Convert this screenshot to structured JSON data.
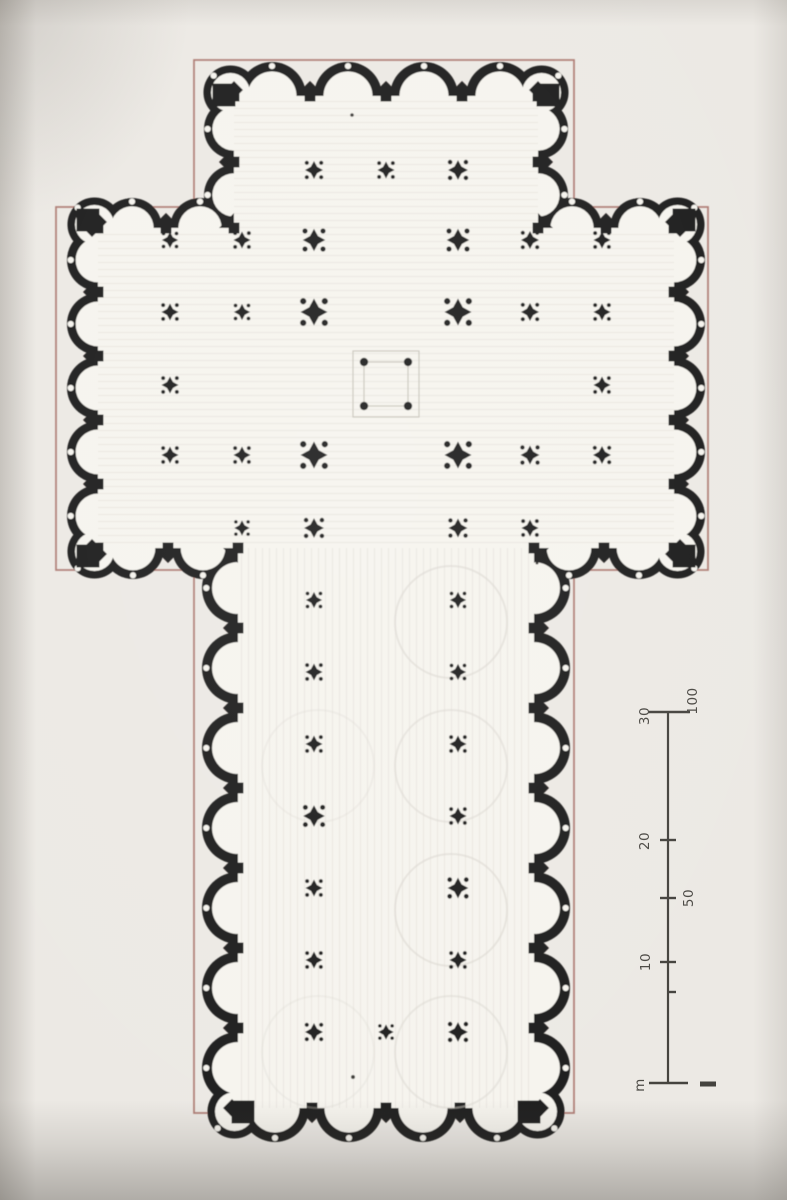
{
  "meta": {
    "description": "Scanned book photograph of a Latin-cross cathedral floor plan, rotated 90 degrees, with semicircular chapel niches scalloping the whole perimeter, an interior grid of cross-shaped piers, a square crossing marked by four dots, thin red construction rectangles around nave and transept, and a double scale bar in metres",
    "plan_type": "cruciform-cathedral-floor-plan"
  },
  "palette": {
    "paper": "#ECE9E4",
    "floor": "#F6F4EE",
    "ink": "#1E1D1B",
    "red_outline": "#AD7A72",
    "faint_line": "#D9D6CF",
    "crossing_line": "#C9C5BC",
    "scale_ink": "#44423D",
    "scale_label_ink": "#4A4843",
    "shade": "#5C564E"
  },
  "plan": {
    "red_frames": [
      {
        "x": 194,
        "y": 60,
        "w": 380,
        "h": 1053
      },
      {
        "x": 56,
        "y": 207,
        "w": 652,
        "h": 363
      }
    ],
    "floors": [
      {
        "x": 234,
        "y": 96,
        "w": 304,
        "h": 132,
        "tex": "h"
      },
      {
        "x": 98,
        "y": 228,
        "w": 576,
        "h": 320,
        "tex": "h"
      },
      {
        "x": 238,
        "y": 548,
        "w": 296,
        "h": 560,
        "tex": "v"
      }
    ],
    "edges": [
      {
        "x1": 234,
        "y1": 96,
        "x2": 538,
        "y2": 96,
        "out": "up",
        "bays": 4,
        "r": 34
      },
      {
        "x1": 234,
        "y1": 96,
        "x2": 234,
        "y2": 228,
        "out": "left",
        "bays": 2,
        "r": 30
      },
      {
        "x1": 538,
        "y1": 96,
        "x2": 538,
        "y2": 228,
        "out": "right",
        "bays": 2,
        "r": 30
      },
      {
        "x1": 98,
        "y1": 228,
        "x2": 234,
        "y2": 228,
        "out": "up",
        "bays": 2,
        "r": 30
      },
      {
        "x1": 538,
        "y1": 228,
        "x2": 674,
        "y2": 228,
        "out": "up",
        "bays": 2,
        "r": 30
      },
      {
        "x1": 98,
        "y1": 228,
        "x2": 98,
        "y2": 548,
        "out": "left",
        "bays": 5,
        "r": 31
      },
      {
        "x1": 674,
        "y1": 228,
        "x2": 674,
        "y2": 548,
        "out": "right",
        "bays": 5,
        "r": 31
      },
      {
        "x1": 98,
        "y1": 548,
        "x2": 238,
        "y2": 548,
        "out": "down",
        "bays": 2,
        "r": 31
      },
      {
        "x1": 534,
        "y1": 548,
        "x2": 674,
        "y2": 548,
        "out": "down",
        "bays": 2,
        "r": 31
      },
      {
        "x1": 238,
        "y1": 548,
        "x2": 238,
        "y2": 1108,
        "out": "left",
        "bays": 7,
        "r": 36
      },
      {
        "x1": 534,
        "y1": 548,
        "x2": 534,
        "y2": 1108,
        "out": "right",
        "bays": 7,
        "r": 36
      },
      {
        "x1": 238,
        "y1": 1108,
        "x2": 534,
        "y2": 1108,
        "out": "down",
        "bays": 4,
        "r": 34
      }
    ],
    "corner_lobes": [
      {
        "x": 234,
        "y": 96,
        "a": -135,
        "r": 27
      },
      {
        "x": 538,
        "y": 96,
        "a": -45,
        "r": 27
      },
      {
        "x": 98,
        "y": 228,
        "a": -135,
        "r": 27
      },
      {
        "x": 674,
        "y": 228,
        "a": -45,
        "r": 27
      },
      {
        "x": 98,
        "y": 548,
        "a": 135,
        "r": 27
      },
      {
        "x": 674,
        "y": 548,
        "a": 45,
        "r": 27
      },
      {
        "x": 238,
        "y": 1108,
        "a": 135,
        "r": 27
      },
      {
        "x": 534,
        "y": 1108,
        "a": 45,
        "r": 27
      }
    ],
    "corner_blocks": [
      {
        "x": 224,
        "y": 95
      },
      {
        "x": 548,
        "y": 95
      },
      {
        "x": 88,
        "y": 220
      },
      {
        "x": 684,
        "y": 220
      },
      {
        "x": 88,
        "y": 556
      },
      {
        "x": 684,
        "y": 556
      },
      {
        "x": 243,
        "y": 1112
      },
      {
        "x": 529,
        "y": 1112
      }
    ],
    "block_size": 23,
    "crossing": {
      "cx": 386,
      "cy": 384,
      "outer": 66,
      "inner": 44,
      "dot_r": 4.2
    },
    "faint_circles": [
      {
        "x": 451,
        "y": 622,
        "r": 56,
        "o": 0.55
      },
      {
        "x": 451,
        "y": 766,
        "r": 56,
        "o": 0.5
      },
      {
        "x": 451,
        "y": 910,
        "r": 56,
        "o": 0.55
      },
      {
        "x": 451,
        "y": 1052,
        "r": 56,
        "o": 0.5
      },
      {
        "x": 318,
        "y": 766,
        "r": 56,
        "o": 0.3
      },
      {
        "x": 318,
        "y": 1052,
        "r": 56,
        "o": 0.3
      }
    ],
    "piers": [
      [
        314,
        170,
        1.0
      ],
      [
        386,
        170,
        0.95
      ],
      [
        458,
        170,
        1.1
      ],
      [
        170,
        240,
        0.9
      ],
      [
        242,
        240,
        0.95
      ],
      [
        314,
        240,
        1.25
      ],
      [
        458,
        240,
        1.25
      ],
      [
        530,
        240,
        1.0
      ],
      [
        602,
        240,
        0.95
      ],
      [
        170,
        312,
        0.95
      ],
      [
        242,
        312,
        0.9
      ],
      [
        314,
        312,
        1.5
      ],
      [
        458,
        312,
        1.5
      ],
      [
        530,
        312,
        1.0
      ],
      [
        602,
        312,
        0.95
      ],
      [
        170,
        385,
        0.95
      ],
      [
        602,
        385,
        0.95
      ],
      [
        170,
        455,
        0.95
      ],
      [
        242,
        455,
        0.95
      ],
      [
        314,
        455,
        1.5
      ],
      [
        458,
        455,
        1.5
      ],
      [
        530,
        455,
        1.05
      ],
      [
        602,
        455,
        1.0
      ],
      [
        242,
        528,
        0.85
      ],
      [
        314,
        528,
        1.1
      ],
      [
        458,
        528,
        1.05
      ],
      [
        530,
        528,
        0.95
      ],
      [
        314,
        600,
        0.9
      ],
      [
        458,
        600,
        0.9
      ],
      [
        314,
        672,
        0.95
      ],
      [
        458,
        672,
        0.9
      ],
      [
        314,
        744,
        0.95
      ],
      [
        458,
        744,
        0.95
      ],
      [
        314,
        816,
        1.2
      ],
      [
        458,
        816,
        0.95
      ],
      [
        314,
        888,
        0.95
      ],
      [
        458,
        888,
        1.15
      ],
      [
        314,
        960,
        0.95
      ],
      [
        458,
        960,
        0.95
      ],
      [
        314,
        1032,
        1.0
      ],
      [
        386,
        1032,
        0.85
      ],
      [
        458,
        1032,
        1.1
      ]
    ],
    "specks": [
      {
        "x": 92,
        "y": 418,
        "r": 2.2
      },
      {
        "x": 352,
        "y": 115,
        "r": 1.8
      },
      {
        "x": 353,
        "y": 1077,
        "r": 2.0
      },
      {
        "x": 537,
        "y": 563,
        "r": 1.5
      }
    ]
  },
  "scale_bar": {
    "x": 668,
    "y_top": 712,
    "y_bottom": 1083,
    "line_w": 2.2,
    "caps": [
      {
        "y": 712,
        "x1": 648,
        "x2": 690
      },
      {
        "y": 1083,
        "x1": 649,
        "x2": 688
      }
    ],
    "ticks": [
      {
        "y": 840,
        "dir": "b",
        "len": 8
      },
      {
        "y": 898,
        "dir": "b",
        "len": 8
      },
      {
        "y": 962,
        "dir": "b",
        "len": 8
      },
      {
        "y": 992,
        "dir": "r",
        "len": 8
      }
    ],
    "labels": [
      {
        "text": "30",
        "x": 645,
        "y": 716
      },
      {
        "text": "100",
        "x": 693,
        "y": 701
      },
      {
        "text": "20",
        "x": 645,
        "y": 841
      },
      {
        "text": "50",
        "x": 689,
        "y": 898
      },
      {
        "text": "10",
        "x": 646,
        "y": 962
      },
      {
        "text": "m",
        "x": 640,
        "y": 1085
      }
    ],
    "zero_dash": {
      "x1": 700,
      "y1": 1084,
      "x2": 716,
      "y2": 1084,
      "w": 5
    }
  }
}
